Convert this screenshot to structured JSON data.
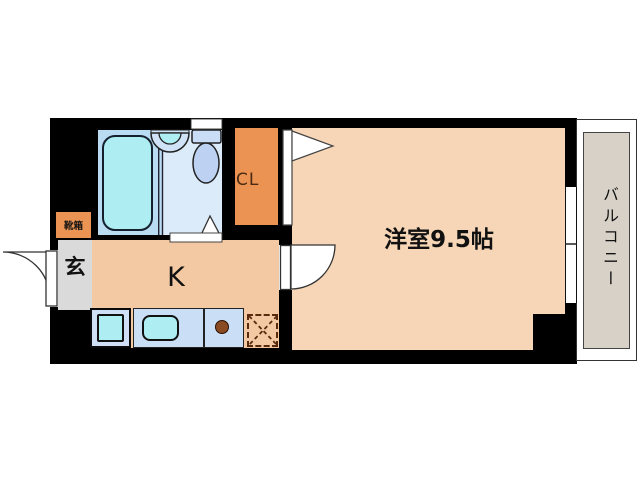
{
  "floorplan": {
    "labels": {
      "main_room": "洋室9.5帖",
      "kitchen": "K",
      "closet": "CL",
      "entrance": "玄",
      "shoe_box": "靴箱",
      "balcony": "バルコニー"
    },
    "colors": {
      "wall": "#000000",
      "main_room": "#f6d6b6",
      "kitchen": "#f3c9a3",
      "closet_orange": "#ea9352",
      "bath_floor": "#badcf3",
      "toilet_floor": "#dcebf9",
      "fixture_cyan": "#aeeef2",
      "counter_blue": "#cadff6",
      "washer_tray_blue": "#cfe0f6",
      "toilet_blue": "#bdd2f2",
      "entrance_gray": "#dadada",
      "balcony_gray": "#d7d1c7",
      "stove_brown": "#8a4a22",
      "dashed_brown": "#5a2a0e",
      "background": "#ffffff"
    },
    "fixtures": [
      "bathtub",
      "washbasin",
      "toilet",
      "kitchen-sink",
      "stove-burner",
      "washer-pan",
      "refrigerator-space",
      "entrance-door",
      "room-door",
      "closet-door",
      "bath-door",
      "sliding-window"
    ]
  }
}
